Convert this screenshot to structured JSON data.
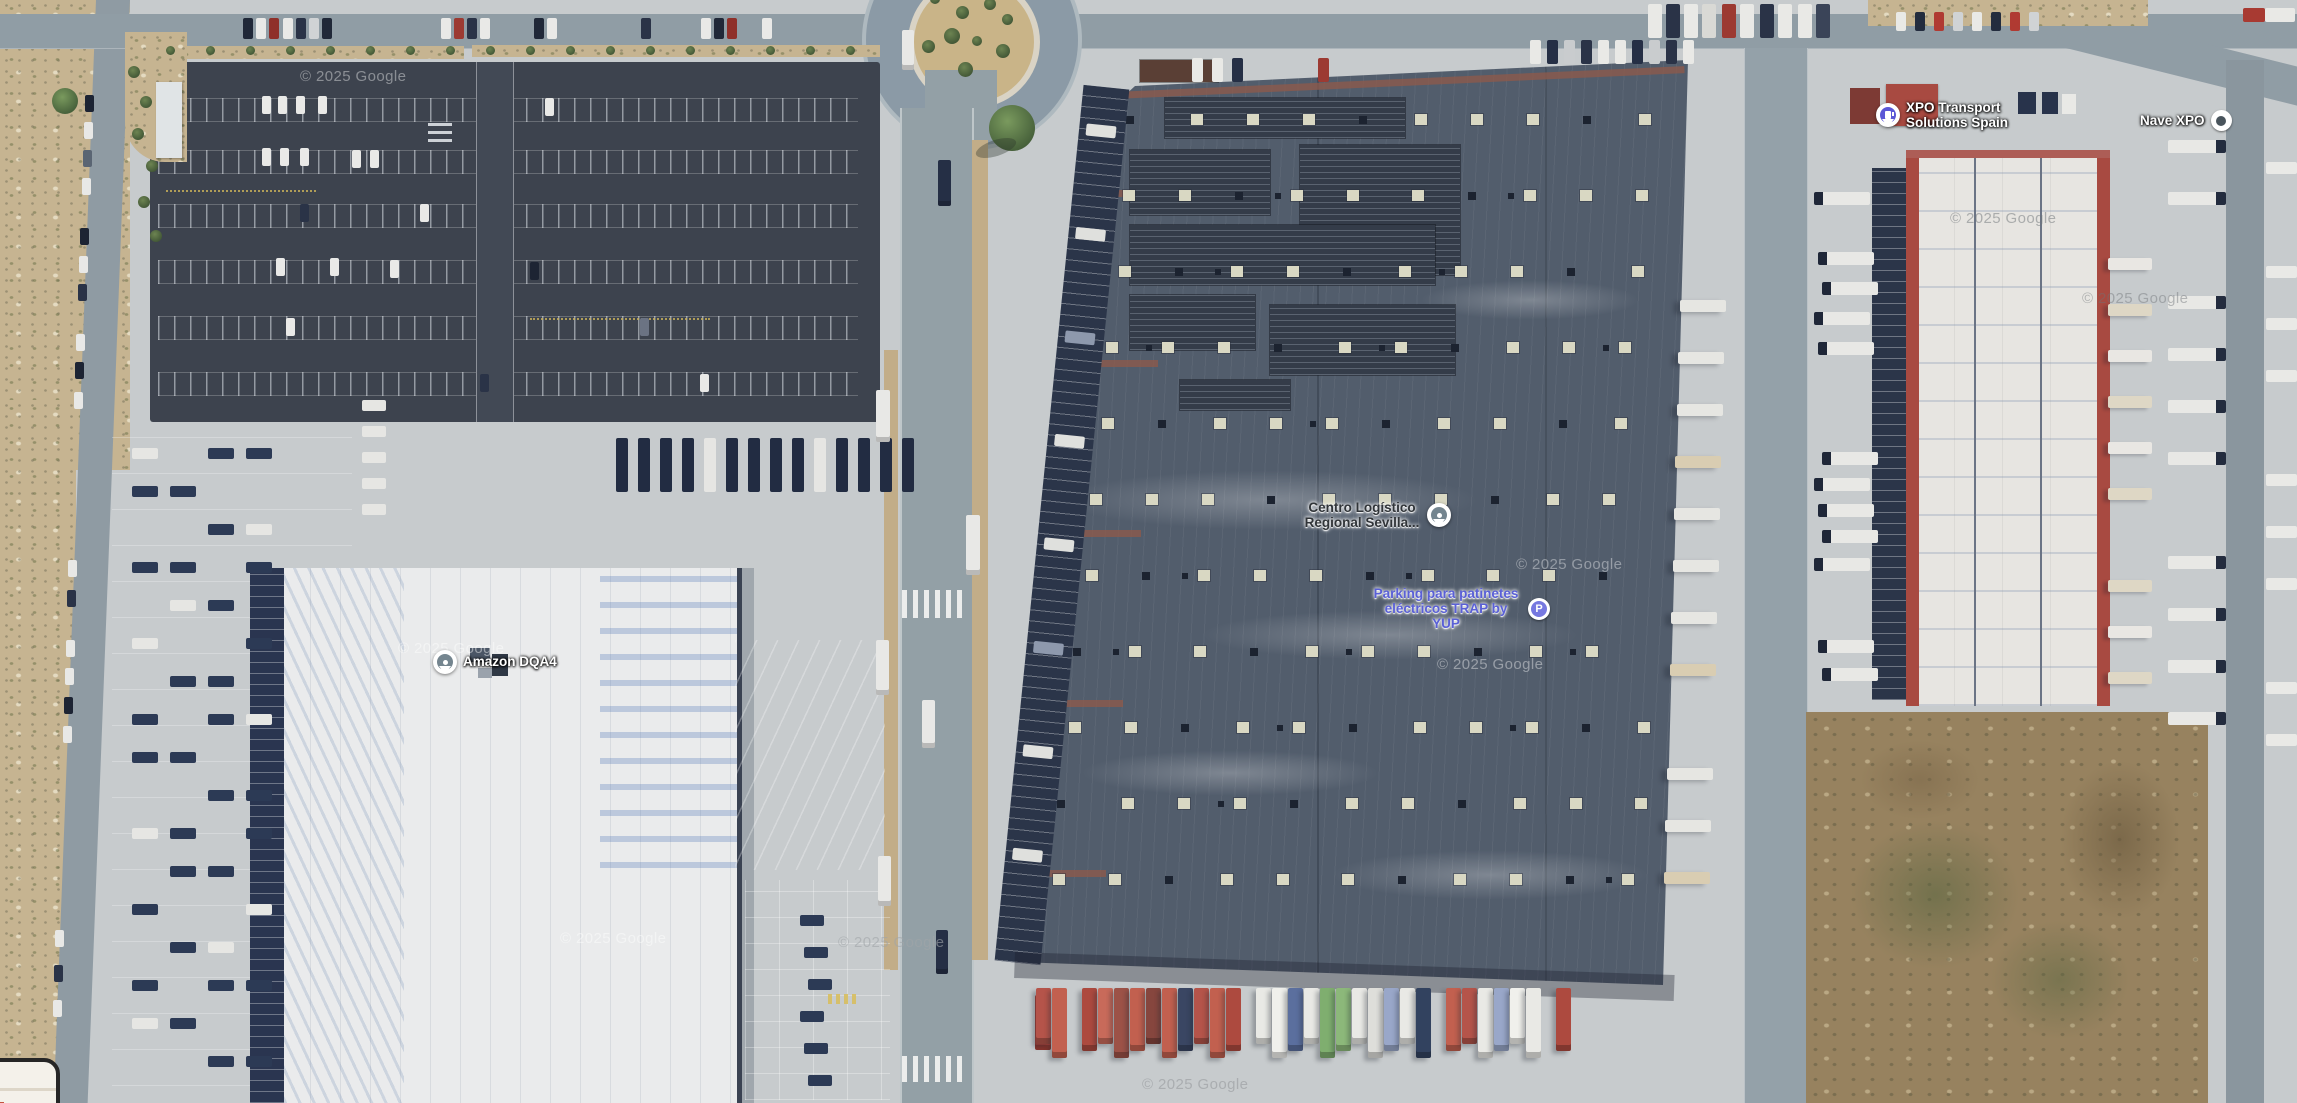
{
  "map": {
    "type": "satellite-aerial-view",
    "attribution_watermark": "© 2025 Google",
    "pois": [
      {
        "id": "amazon-dqa4",
        "label": "Amazon DQA4",
        "pin": "teardrop-dot-marker"
      },
      {
        "id": "centro-logistico",
        "label": "Centro Logístico Regional Sevilla...",
        "pin": "teardrop-dot-marker"
      },
      {
        "id": "parking-patinetes",
        "label": "Parking para patinetes eléctricos TRAP by YUP",
        "pin": "parking-icon"
      },
      {
        "id": "xpo-transport",
        "label": "XPO Transport Solutions Spain",
        "pin": "business-pin"
      },
      {
        "id": "nave-xpo",
        "label": "Nave XPO",
        "pin": "circle-dot-marker"
      }
    ],
    "icons": {
      "parking_badge_letter": "P"
    },
    "palette": {
      "concrete": "#c7cbcd",
      "road": "#95a1a8",
      "parking_asphalt": "#3d434e",
      "warehouse_roof": "#525d6c",
      "skylight": "#d9d8c3",
      "amazon_roof": "#eaebec",
      "xpo_red": "#a84a41",
      "dock_navy": "#28334b",
      "scrub": "#c6b491",
      "dirt": "#97825f",
      "poi_violet": "#5a60d6",
      "pin_indigo": "#5b57d6"
    },
    "south_dock_trailer_colors": [
      "#b5544a",
      "#c2604f",
      "gap",
      "#ad4a3f",
      "#c86a5a",
      "#9c5247",
      "#c2604f",
      "#86463e",
      "#c2604f",
      "#3a4663",
      "#b5544a",
      "#c2604f",
      "#ad4a3f",
      "gap",
      "#e9e9e5",
      "#f0f0ec",
      "#5b6f9e",
      "#e9e9e5",
      "#7fae6f",
      "#8cb87a",
      "#e9e9e5",
      "#dededa",
      "#99a7c9",
      "#e9e9e5",
      "#32425f",
      "gap",
      "#c2604f",
      "#b5544a",
      "#e9e9e5",
      "#99a7c9",
      "#f0f0ec",
      "#e9e9e5",
      "gap",
      "#ad4a3f"
    ]
  }
}
